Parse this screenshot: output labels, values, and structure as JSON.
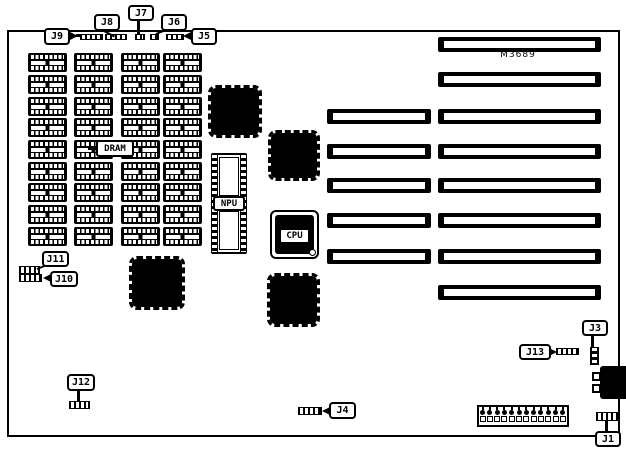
{
  "board": {
    "model": "M3689"
  },
  "labels": {
    "dram": "DRAM",
    "npu": "NPU",
    "cpu": "CPU",
    "j1": "J1",
    "j3": "J3",
    "j4": "J4",
    "j5": "J5",
    "j6": "J6",
    "j7": "J7",
    "j8": "J8",
    "j9": "J9",
    "j10": "J10",
    "j11": "J11",
    "j12": "J12",
    "j13": "J13"
  }
}
